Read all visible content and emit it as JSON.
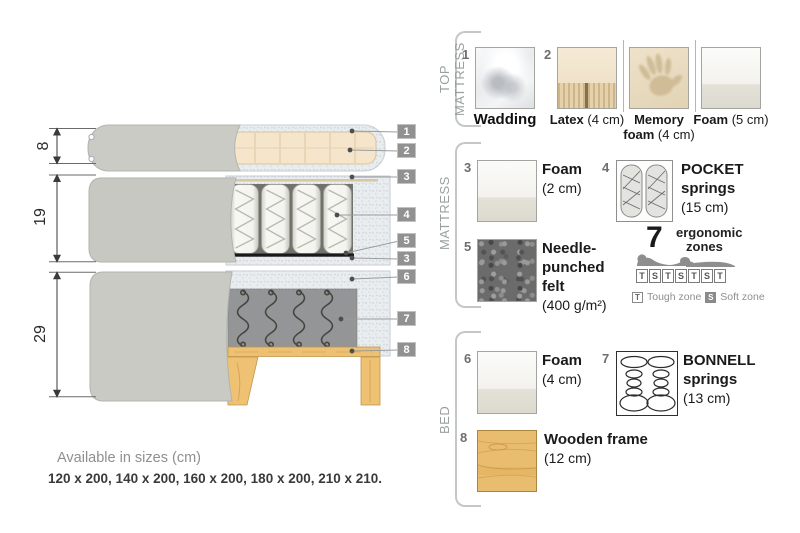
{
  "diagram": {
    "dims": [
      {
        "label": "8"
      },
      {
        "label": "19"
      },
      {
        "label": "29"
      }
    ],
    "tags": [
      {
        "label": "1"
      },
      {
        "label": "2"
      },
      {
        "label": "3"
      },
      {
        "label": "4"
      },
      {
        "label": "5"
      },
      {
        "label": "3"
      },
      {
        "label": "6"
      },
      {
        "label": "7"
      },
      {
        "label": "8"
      }
    ],
    "sizes_title": "Available in sizes (cm)",
    "sizes_list": "120 x 200, 140 x 200, 160 x 200, 180 x 200, 210 x 210."
  },
  "panel": {
    "sections": [
      {
        "label": "TOP MATTRESS"
      },
      {
        "label": "MATTRESS"
      },
      {
        "label": "BED"
      }
    ],
    "items": {
      "wadding": {
        "num": "1",
        "name": "Wadding"
      },
      "latex": {
        "num": "2",
        "name": "Latex",
        "size": "(4 cm)"
      },
      "memory_foam": {
        "name_line1": "Memory",
        "name_line2": "foam",
        "size": "(4 cm)"
      },
      "foam_5": {
        "name": "Foam",
        "size": "(5 cm)"
      },
      "foam_2": {
        "num": "3",
        "name": "Foam",
        "size": "(2 cm)"
      },
      "pocket_springs": {
        "num": "4",
        "name_line1": "POCKET",
        "name_line2": "springs",
        "size": "(15 cm)"
      },
      "needle_felt": {
        "num": "5",
        "name": "Needle-punched felt",
        "size": "(400 g/m²)"
      },
      "ergonomic_zones": {
        "count": "7",
        "label_line1": "ergonomic",
        "label_line2": "zones",
        "boxes": [
          "T",
          "S",
          "T",
          "S",
          "T",
          "S",
          "T"
        ],
        "legend_tough_key": "T",
        "legend_tough": "Tough zone",
        "legend_soft_key": "S",
        "legend_soft": "Soft zone"
      },
      "foam_4": {
        "num": "6",
        "name": "Foam",
        "size": "(4 cm)"
      },
      "bonnell_springs": {
        "num": "7",
        "name_line1": "BONNELL",
        "name_line2": "springs",
        "size": "(13 cm)"
      },
      "wooden_frame": {
        "num": "8",
        "name": "Wooden frame",
        "size": "(12 cm)"
      }
    },
    "colors": {
      "wood": "#eec173",
      "fabric_grey": "#c8cac3",
      "tag_grey": "#919191",
      "panel_label_grey": "#9aa0a0"
    }
  }
}
